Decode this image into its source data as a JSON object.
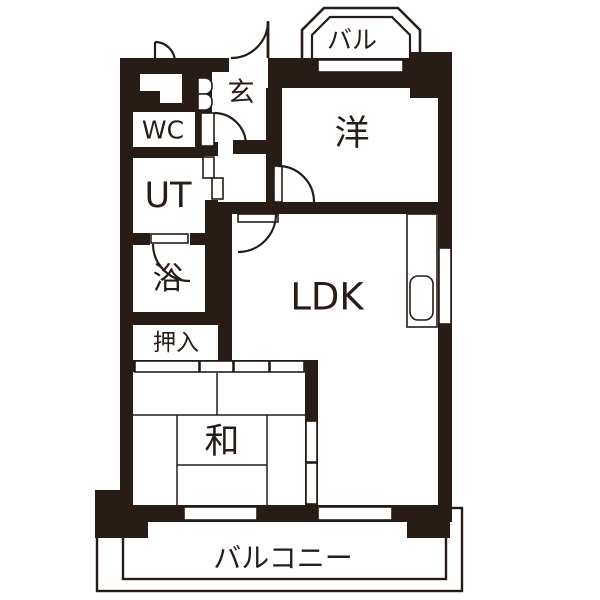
{
  "floorplan": {
    "title": "apartment-floorplan",
    "colors": {
      "wall": "#271c16",
      "background": "#ffffff"
    },
    "rooms": [
      {
        "id": "bay-balcony",
        "label": "バル"
      },
      {
        "id": "entrance",
        "label": "玄"
      },
      {
        "id": "toilet",
        "label": "WC"
      },
      {
        "id": "utility",
        "label": "UT"
      },
      {
        "id": "bath",
        "label": "浴"
      },
      {
        "id": "closet",
        "label": "押入"
      },
      {
        "id": "western-room",
        "label": "洋"
      },
      {
        "id": "ldk",
        "label": "LDK"
      },
      {
        "id": "japanese-room",
        "label": "和"
      },
      {
        "id": "balcony",
        "label": "バルコニー"
      }
    ]
  }
}
